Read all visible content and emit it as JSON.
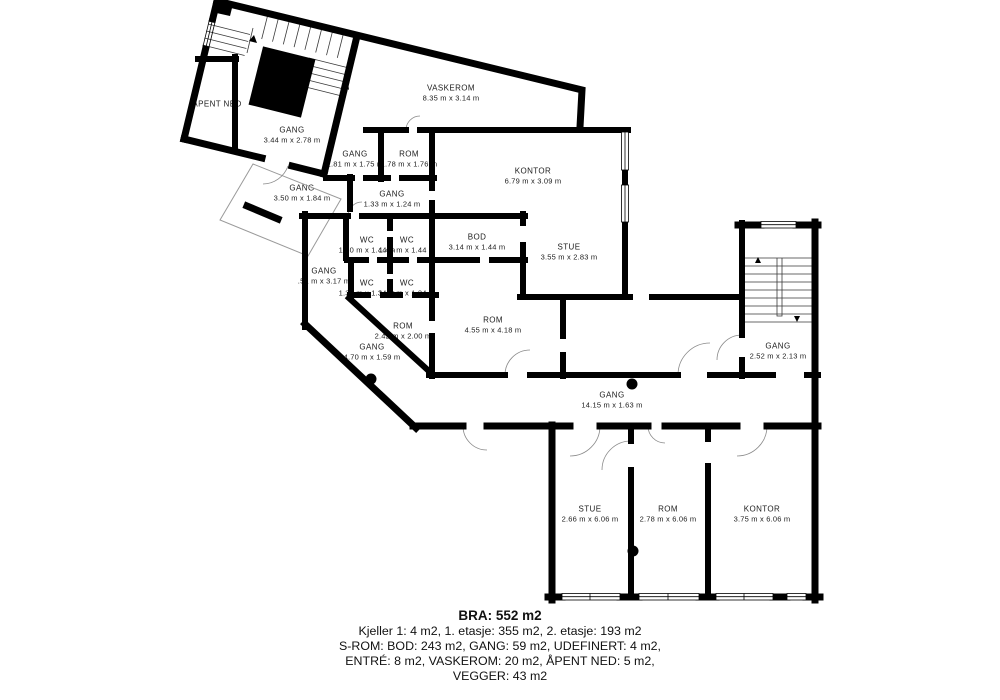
{
  "plan": {
    "background": "#ffffff",
    "wall_color": "#000000",
    "floor": "2. etasje"
  },
  "rooms": [
    {
      "name": "ÅPENT NED",
      "dims": ""
    },
    {
      "name": "GANG",
      "dims": "3.44 m x 2.78 m"
    },
    {
      "name": "VASKEROM",
      "dims": "8.35 m x 3.14 m"
    },
    {
      "name": "GANG",
      "dims": "1.81 m x 1.75 m"
    },
    {
      "name": "ROM",
      "dims": "1.78 m x 1.76 m"
    },
    {
      "name": "KONTOR",
      "dims": "6.79 m x 3.09 m"
    },
    {
      "name": "GANG",
      "dims": "3.50 m x 1.84 m"
    },
    {
      "name": "GANG",
      "dims": "1.33 m x 1.24 m"
    },
    {
      "name": "WC",
      "dims": "1.30 m x 1.44 m"
    },
    {
      "name": "WC",
      "dims": "1.46 m x 1.44 m"
    },
    {
      "name": "BOD",
      "dims": "3.14 m x 1.44 m"
    },
    {
      "name": "STUE",
      "dims": "3.55 m x 2.83 m"
    },
    {
      "name": "GANG",
      "dims": ".51 m x 3.17 m"
    },
    {
      "name": "WC",
      "dims": "1.30 m x 1.34 m"
    },
    {
      "name": "WC",
      "dims": "1.46 m x 1.34 m"
    },
    {
      "name": "ROM",
      "dims": "4.55 m x 4.18 m"
    },
    {
      "name": "ROM",
      "dims": "2.42 m x 2.00 m"
    },
    {
      "name": "GANG",
      "dims": "4.70 m x 1.59 m"
    },
    {
      "name": "GANG",
      "dims": "2.52 m x 2.13 m"
    },
    {
      "name": "GANG",
      "dims": "14.15 m x 1.63 m"
    },
    {
      "name": "STUE",
      "dims": "2.66 m x 6.06 m"
    },
    {
      "name": "ROM",
      "dims": "2.78 m x 6.06 m"
    },
    {
      "name": "KONTOR",
      "dims": "3.75 m x 6.06 m"
    }
  ],
  "footer": {
    "title": "BRA: 552 m2",
    "lines": [
      "Kjeller 1: 4 m2, 1. etasje: 355 m2, 2. etasje: 193 m2",
      "S-ROM: BOD: 243 m2, GANG: 59 m2, UDEFINERT: 4 m2,",
      "ENTRÉ: 8 m2, VASKEROM: 20 m2, ÅPENT NED: 5 m2,",
      "VEGGER: 43 m2"
    ]
  }
}
